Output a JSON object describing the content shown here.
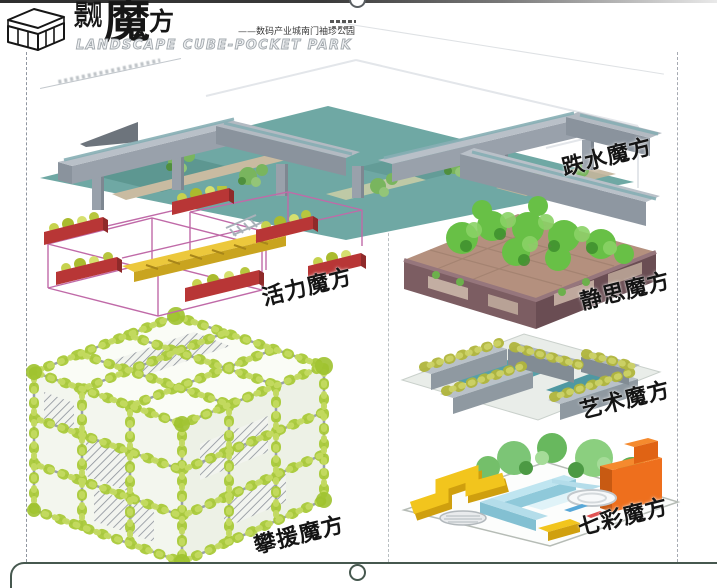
{
  "page": {
    "background": "#ffffff",
    "title_block": {
      "logo_zh_prefix": "景观",
      "logo_zh_magic": "魔",
      "logo_zh_fang": "方",
      "subtitle_zh": "——数码产业城南门袖珍公园",
      "title_en": "LANDSCAPE CUBE-POCKET PARK"
    }
  },
  "cubes": [
    {
      "name": "cascade-cube",
      "label": "跌水魔方",
      "accent": "#6fa8a4"
    },
    {
      "name": "vitality-cube",
      "label": "活力魔方",
      "accent": "#c0549e"
    },
    {
      "name": "meditation-cube",
      "label": "静思魔方",
      "accent": "#7c5d62"
    },
    {
      "name": "art-cube",
      "label": "艺术魔方",
      "accent": "#9aa4ac"
    },
    {
      "name": "climbing-cube",
      "label": "攀援魔方",
      "accent": "#a9c938"
    },
    {
      "name": "rainbow-cube",
      "label": "七彩魔方",
      "accent": "#f58a2e"
    }
  ]
}
